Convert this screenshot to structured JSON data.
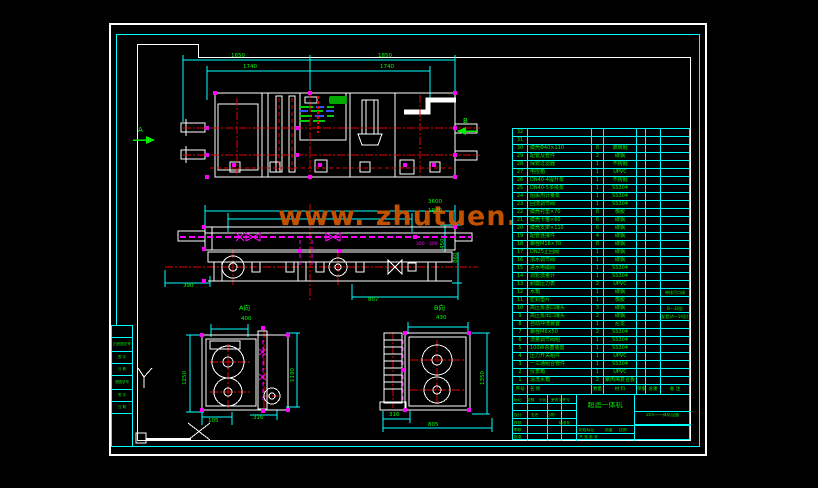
{
  "watermark": {
    "text": "www. zhutuen. com",
    "color": "#cc5500"
  },
  "colors": {
    "background": "#000000",
    "grid_cyan": "#00ffff",
    "annotation_green": "#00ee00",
    "centerline_red": "#e60000",
    "highlight_magenta": "#ff00ff",
    "linework_white": "#ffffff",
    "watermark_orange": "#cc5500",
    "panel_green_fill": "#00aa00",
    "panel_blue": "#3355ff"
  },
  "dim_labels": [
    {
      "name": "dim-top-outer-left",
      "text": "1650",
      "x": 231,
      "y": 54
    },
    {
      "name": "dim-top-outer-right",
      "text": "1850",
      "x": 378,
      "y": 54
    },
    {
      "name": "dim-top-inner-left",
      "text": "1740",
      "x": 243,
      "y": 65
    },
    {
      "name": "dim-top-inner-right",
      "text": "1740",
      "x": 380,
      "y": 65
    },
    {
      "name": "section-marker-a",
      "text": "A",
      "x": 138,
      "y": 127,
      "size": 7
    },
    {
      "name": "section-marker-b",
      "text": "B",
      "x": 463,
      "y": 118,
      "size": 7
    },
    {
      "name": "dim-front-3600",
      "text": "3600",
      "x": 428,
      "y": 200
    },
    {
      "name": "dim-front-1900",
      "text": "1900",
      "x": 428,
      "y": 209
    },
    {
      "name": "dim-front-390",
      "text": "390",
      "x": 183,
      "y": 284
    },
    {
      "name": "dim-front-807",
      "text": "807",
      "x": 368,
      "y": 298
    },
    {
      "name": "dim-front-450",
      "text": "450",
      "x": 441,
      "y": 249,
      "rot": true
    },
    {
      "name": "dim-front-860",
      "text": "860",
      "x": 454,
      "y": 263,
      "rot": true
    },
    {
      "name": "dim-front-300a",
      "text": "300",
      "x": 416,
      "y": 243,
      "size": 4.5,
      "color": "#ff00ff"
    },
    {
      "name": "dim-front-300b",
      "text": "300",
      "x": 429,
      "y": 243,
      "size": 4.5,
      "color": "#ff00ff"
    },
    {
      "name": "view-a-label",
      "text": "A向",
      "x": 239,
      "y": 305,
      "size": 6.5
    },
    {
      "name": "dim-a-400",
      "text": "400",
      "x": 241,
      "y": 317
    },
    {
      "name": "dim-a-1250",
      "text": "1250",
      "x": 183,
      "y": 385,
      "rot": true
    },
    {
      "name": "dim-a-1190",
      "text": "1190",
      "x": 291,
      "y": 382,
      "rot": true
    },
    {
      "name": "dim-a-105",
      "text": "105",
      "x": 208,
      "y": 419
    },
    {
      "name": "dim-a-316",
      "text": "316",
      "x": 253,
      "y": 416
    },
    {
      "name": "view-b-label",
      "text": "B向",
      "x": 434,
      "y": 305,
      "size": 6.5
    },
    {
      "name": "dim-b-430",
      "text": "430",
      "x": 436,
      "y": 316
    },
    {
      "name": "dim-b-1350",
      "text": "1350",
      "x": 481,
      "y": 385,
      "rot": true
    },
    {
      "name": "dim-b-316",
      "text": "316",
      "x": 389,
      "y": 413
    },
    {
      "name": "dim-b-805",
      "text": "805",
      "x": 428,
      "y": 423
    }
  ],
  "bom": {
    "headers": {
      "no": "序号",
      "name": "名  称",
      "qty": "数量",
      "material": "材 料",
      "weight_single": "单重",
      "weight_total": "总重",
      "remark": "备 注"
    },
    "rows": [
      {
        "no": "32",
        "name": "",
        "qty": "",
        "material": "",
        "remark": ""
      },
      {
        "no": "31",
        "name": "",
        "qty": "",
        "material": "",
        "remark": ""
      },
      {
        "no": "30",
        "name": "膜壳Φ40×110",
        "qty": "8",
        "material": "玻璃钢",
        "remark": ""
      },
      {
        "no": "29",
        "name": "配管及管件",
        "qty": "2",
        "material": "碳钢",
        "remark": ""
      },
      {
        "no": "28",
        "name": "保安过滤器",
        "qty": "1",
        "material": "不锈钢",
        "remark": ""
      },
      {
        "no": "27",
        "name": "电控箱",
        "qty": "1",
        "material": "UPVC",
        "remark": ""
      },
      {
        "no": "26",
        "name": "DN40-4提升泵",
        "qty": "1",
        "material": "不锈钢",
        "remark": ""
      },
      {
        "no": "25",
        "name": "DN40-5多级泵",
        "qty": "1",
        "material": "SS304",
        "remark": ""
      },
      {
        "no": "24",
        "name": "阻垢剂计量泵",
        "qty": "1",
        "material": "SS304",
        "remark": ""
      },
      {
        "no": "23",
        "name": "回流调节阀",
        "qty": "1",
        "material": "SS304",
        "remark": ""
      },
      {
        "no": "22",
        "name": "膜壳衬垫×70",
        "qty": "8",
        "material": "橡胶",
        "remark": ""
      },
      {
        "no": "21",
        "name": "膜壳卡箍×60",
        "qty": "6",
        "material": "碳钢",
        "remark": ""
      },
      {
        "no": "20",
        "name": "膜壳支架×110",
        "qty": "6",
        "material": "碳钢",
        "remark": ""
      },
      {
        "no": "19",
        "name": "配管连接件",
        "qty": "4",
        "material": "碳钢",
        "remark": ""
      },
      {
        "no": "18",
        "name": "螺栓M16×70",
        "qty": "8",
        "material": "碳钢",
        "remark": ""
      },
      {
        "no": "17",
        "name": "DN25止回阀",
        "qty": "1",
        "material": "碳钢",
        "remark": ""
      },
      {
        "no": "16",
        "name": "浓水调节阀",
        "qty": "1",
        "material": "碳钢",
        "remark": ""
      },
      {
        "no": "15",
        "name": "进水电磁阀",
        "qty": "1",
        "material": "SS304",
        "remark": ""
      },
      {
        "no": "14",
        "name": "涡轮流量计",
        "qty": "1",
        "material": "SS304",
        "remark": ""
      },
      {
        "no": "13",
        "name": "耐震压力表",
        "qty": "2",
        "material": "UPVC",
        "remark": ""
      },
      {
        "no": "12",
        "name": "水箱",
        "qty": "1",
        "material": "碳钢",
        "remark": "带排污口阀"
      },
      {
        "no": "11",
        "name": "密封垫片",
        "qty": "1",
        "material": "橡胶",
        "remark": ""
      },
      {
        "no": "10",
        "name": "高压泵进口接头",
        "qty": "3",
        "material": "碳钢",
        "remark": "B—16型"
      },
      {
        "no": "9",
        "name": "高压泵出口接头",
        "qty": "2",
        "material": "碳钢",
        "remark": "配套(A—16型)"
      },
      {
        "no": "8",
        "name": "自动冲洗装置",
        "qty": "1",
        "material": "尼龙",
        "remark": ""
      },
      {
        "no": "7",
        "name": "螺栓M6×50",
        "qty": "2",
        "material": "SS304",
        "remark": ""
      },
      {
        "no": "6",
        "name": "流量调节阀组",
        "qty": "1",
        "material": "SS304",
        "remark": ""
      },
      {
        "no": "5",
        "name": "100W杀菌装置",
        "qty": "1",
        "material": "SS304",
        "remark": ""
      },
      {
        "no": "4",
        "name": "压力开关组件",
        "qty": "1",
        "material": "UPVC",
        "remark": ""
      },
      {
        "no": "3",
        "name": "一三通组合管件",
        "qty": "1",
        "material": "SS304",
        "remark": ""
      },
      {
        "no": "2",
        "name": "仪表箱",
        "qty": "1",
        "material": "UPVC",
        "remark": ""
      },
      {
        "no": "1",
        "name": "清洗水箱",
        "qty": "2",
        "material": "聚丙烯复合板",
        "remark": ""
      }
    ]
  },
  "title_block": {
    "title": {
      "text": "超滤一体机",
      "x": 576,
      "y": 401,
      "w": 56,
      "size": 7
    },
    "model": {
      "text": "5t/h—一体化设备",
      "x": 634,
      "y": 412,
      "w": 55,
      "size": 4.2
    },
    "labels": [
      {
        "text": "标记",
        "x": 513,
        "y": 397
      },
      {
        "text": "处数",
        "x": 526,
        "y": 397
      },
      {
        "text": "分区",
        "x": 538,
        "y": 397
      },
      {
        "text": "更改文件号",
        "x": 550,
        "y": 397
      },
      {
        "text": "设计",
        "x": 513,
        "y": 412
      },
      {
        "text": "签名",
        "x": 530,
        "y": 412
      },
      {
        "text": "日期",
        "x": 546,
        "y": 412
      },
      {
        "text": "校核",
        "x": 513,
        "y": 420
      },
      {
        "text": "标准化",
        "x": 558,
        "y": 420
      },
      {
        "text": "审核",
        "x": 513,
        "y": 427
      },
      {
        "text": "阶段标记",
        "x": 578,
        "y": 427
      },
      {
        "text": "质量",
        "x": 604,
        "y": 427
      },
      {
        "text": "比例",
        "x": 618,
        "y": 427
      },
      {
        "text": "批准",
        "x": 513,
        "y": 434
      },
      {
        "text": "共 张 第 张",
        "x": 578,
        "y": 434
      }
    ]
  },
  "margin_strip": {
    "rows": [
      {
        "h": 12,
        "label": ""
      },
      {
        "h": 14,
        "label": "旧底图总号"
      },
      {
        "h": 12,
        "label": "签 字"
      },
      {
        "h": 12,
        "label": "日 期"
      },
      {
        "h": 14,
        "label": "底图总号"
      },
      {
        "h": 12,
        "label": "签 字"
      },
      {
        "h": 12,
        "label": "日 期"
      },
      {
        "h": 32,
        "label": ""
      }
    ]
  }
}
